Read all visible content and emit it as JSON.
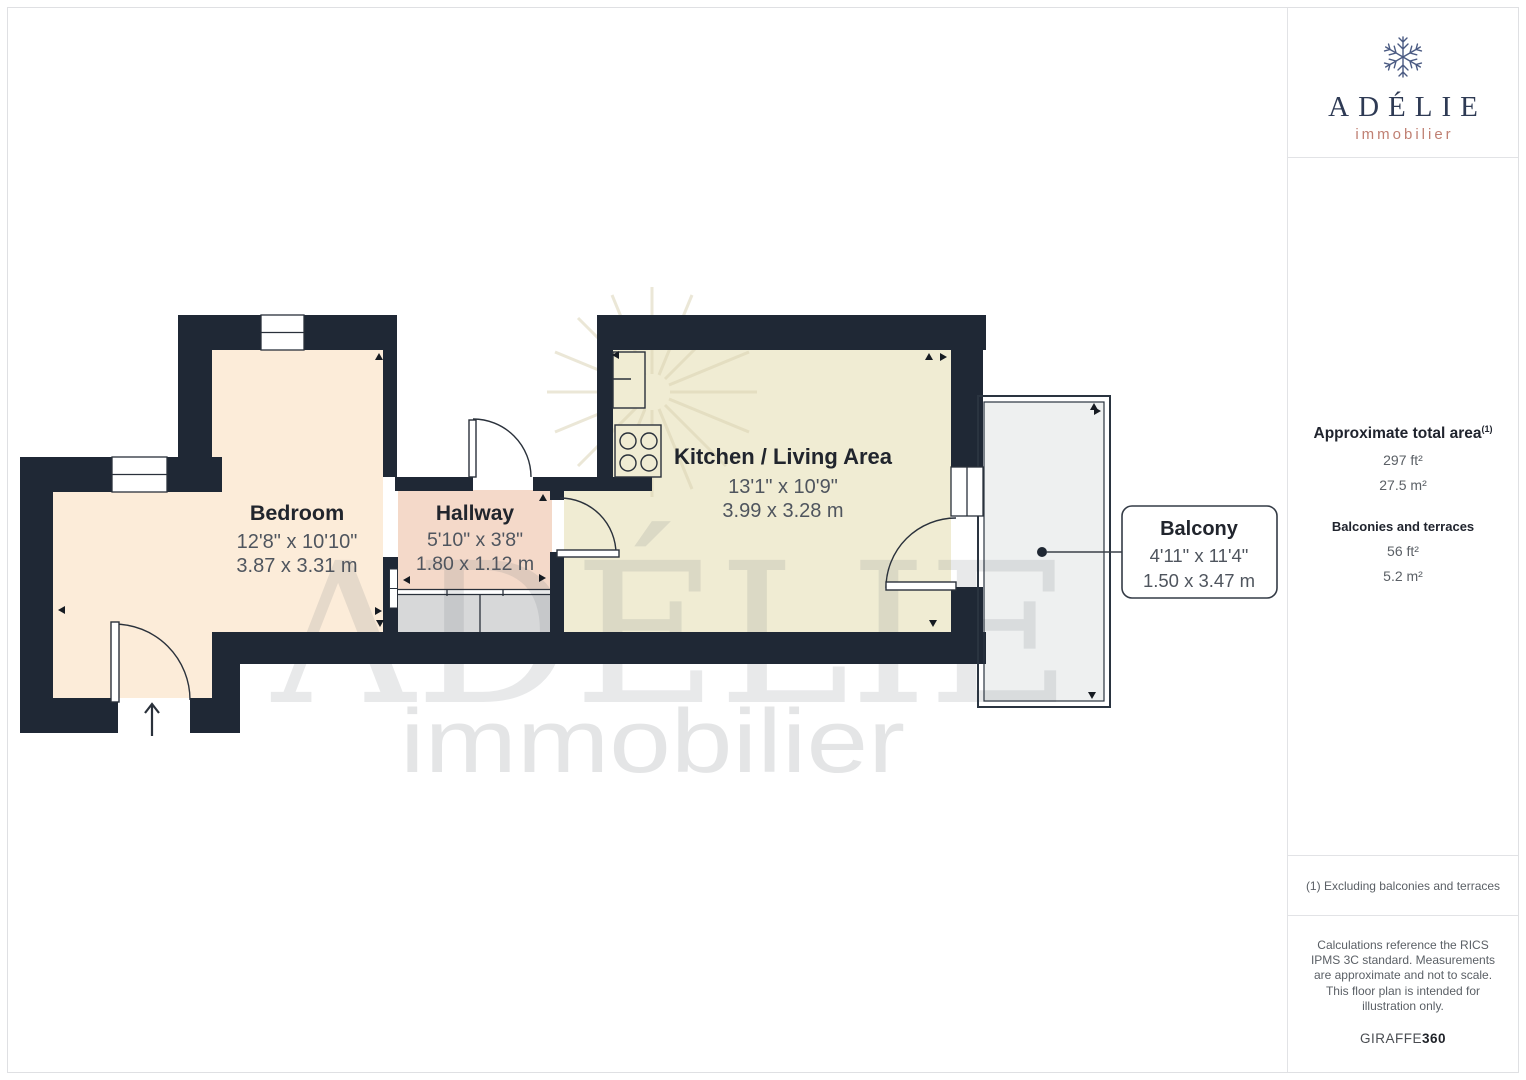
{
  "floorplan": {
    "rooms": [
      {
        "name": "Bedroom",
        "imperial": "12'8\" x 10'10\"",
        "metric": "3.87 x 3.31 m"
      },
      {
        "name": "Hallway",
        "imperial": "5'10\" x 3'8\"",
        "metric": "1.80 x 1.12 m"
      },
      {
        "name": "Kitchen / Living Area",
        "imperial": "13'1\" x 10'9\"",
        "metric": "3.99 x 3.28 m"
      },
      {
        "name": "Balcony",
        "imperial": "4'11\" x 11'4\"",
        "metric": "1.50 x 3.47 m"
      }
    ],
    "watermark": {
      "title": "ADÉLIE",
      "subtitle": "immobilier"
    },
    "colors": {
      "wall": "#1f2835",
      "bedroom": "#fcecd9",
      "hallway": "#f4d9c9",
      "kitchen": "#f0ecd3",
      "closet": "#d7d8d9",
      "balcony": "#eef0f0",
      "logo_navy": "#2e3a54",
      "logo_coral": "#c08073"
    }
  },
  "sidebar": {
    "logo": {
      "name": "ADÉLIE",
      "subtitle": "immobilier"
    },
    "area": {
      "heading": "Approximate total area",
      "heading_ref": "(1)",
      "total_imperial": "297 ft²",
      "total_metric": "27.5 m²",
      "balconies_heading": "Balconies and terraces",
      "balconies_imperial": "56 ft²",
      "balconies_metric": "5.2 m²"
    },
    "footnote": "(1) Excluding balconies and terraces",
    "disclaimer": "Calculations reference the RICS IPMS 3C standard. Measurements are approximate and not to scale. This floor plan is intended for illustration only.",
    "brand": {
      "name": "GIRAFFE",
      "suffix": "360"
    }
  }
}
